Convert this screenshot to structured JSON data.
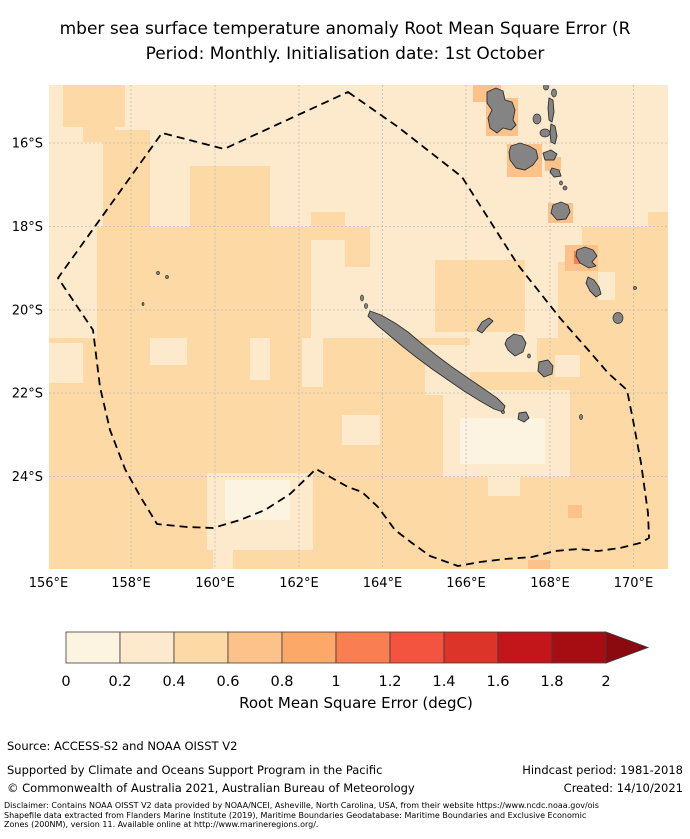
{
  "title": {
    "line1": "mber sea surface temperature anomaly Root Mean Square Error (R",
    "line2": "Period: Monthly. Initialisation date: 1st October"
  },
  "map": {
    "x_tick_labels": [
      "156°E",
      "158°E",
      "160°E",
      "162°E",
      "164°E",
      "166°E",
      "168°E",
      "170°E"
    ],
    "y_tick_labels": [
      "16°S",
      "18°S",
      "20°S",
      "22°S",
      "24°S"
    ],
    "land_color": "#848484",
    "land_edge_color": "#2f2f2f",
    "grid_color": "#bdbdbd",
    "eez_color": "#000000",
    "ocean_base_bin": 1
  },
  "colorbar": {
    "label": "Root Mean Square Error (degC)",
    "tick_labels": [
      "0",
      "0.2",
      "0.4",
      "0.6",
      "0.8",
      "1",
      "1.2",
      "1.4",
      "1.6",
      "1.8",
      "2"
    ],
    "colors": [
      "#fdf3e1",
      "#fdeacc",
      "#fcd9a5",
      "#fcc289",
      "#fba869",
      "#f97e52",
      "#f25440",
      "#dc3428",
      "#c3161b",
      "#a60d12"
    ],
    "arrow_color": "#8a0a10",
    "border_color": "#3c3c3c"
  },
  "footer": {
    "source": "Source: ACCESS-S2 and NOAA OISST V2",
    "supported": "Supported by Climate and Oceans Support Program in the Pacific",
    "hindcast": "Hindcast period: 1981-2018",
    "copyright": "© Commonwealth of Australia 2021, Australian Bureau of Meteorology",
    "created": "Created: 14/10/2021",
    "disclaimer_lines": [
      "Disclaimer: Contains NOAA OISST V2 data provided by NOAA/NCEI, Asheville, North Carolina, USA, from their website https://www.ncdc.noaa.gov/ois",
      "Shapefile data extracted from Flanders Marine Institute (2019), Maritime Boundaries Geodatabase: Maritime Boundaries and Exclusive Economic",
      "Zones (200NM), version 11. Available online at http://www.marineregions.org/."
    ]
  },
  "chart_data": {
    "type": "heatmap",
    "title": "mber sea surface temperature anomaly Root Mean Square Error (R",
    "subtitle": "Period: Monthly. Initialisation date: 1st October",
    "xlabel": "",
    "ylabel": "",
    "x_axis_ticks": [
      "156°E",
      "158°E",
      "160°E",
      "162°E",
      "164°E",
      "166°E",
      "168°E",
      "170°E"
    ],
    "y_axis_ticks": [
      "16°S",
      "18°S",
      "20°S",
      "22°S",
      "24°S"
    ],
    "lon_range_deg_east": [
      155.9,
      170.7
    ],
    "lat_range_deg_south": [
      14.6,
      26.2
    ],
    "colorbar": {
      "label": "Root Mean Square Error (degC)",
      "ticks": [
        0,
        0.2,
        0.4,
        0.6,
        0.8,
        1,
        1.2,
        1.4,
        1.6,
        1.8,
        2
      ],
      "extend": "max",
      "bin_colors": [
        "#fdf3e1",
        "#fdeacc",
        "#fcd9a5",
        "#fcc289",
        "#fba869",
        "#f97e52",
        "#f25440",
        "#dc3428",
        "#c3161b",
        "#a60d12"
      ]
    },
    "field_summary": {
      "north_of_20S": "mostly 0.2-0.4 degC",
      "south_of_20S": "mostly 0.4-0.6 degC with 0.2-0.4 and 0-0.2 patches southeast of New Caledonia and near 161E 24.5S",
      "near_vanuatu_islands": "0.6-0.8 degC cells, one 1.0-1.2 degC cell west of Erromango",
      "overlays": [
        "dashed EEZ boundary polygon",
        "New Caledonia",
        "Loyalty Islands",
        "Vanuatu island chain",
        "Chesterfield reef dots"
      ]
    },
    "geometry": {
      "map_rect": {
        "x": 49,
        "y": 85,
        "w": 619,
        "h": 484
      },
      "x_tick_px": [
        48.5,
        131,
        215,
        299,
        382.5,
        466,
        550,
        633.5
      ],
      "y_tick_px": [
        143,
        226.5,
        310,
        393,
        476.5
      ],
      "x_label_baseline": 587,
      "y_label_right": 43,
      "patches": [
        [
          63,
          85,
          62,
          42,
          2
        ],
        [
          83,
          120,
          32,
          22,
          2
        ],
        [
          103,
          130,
          47,
          100,
          2
        ],
        [
          190,
          166,
          80,
          61,
          2
        ],
        [
          97,
          227,
          214,
          118,
          2
        ],
        [
          311,
          212,
          34,
          28,
          2
        ],
        [
          648,
          212,
          20,
          26,
          2
        ],
        [
          582,
          227,
          86,
          40,
          2
        ],
        [
          558,
          262,
          110,
          83,
          2
        ],
        [
          435,
          260,
          90,
          72,
          2
        ],
        [
          345,
          227,
          25,
          40,
          2
        ],
        [
          49,
          338,
          619,
          231,
          2
        ],
        [
          150,
          338,
          37,
          27,
          1
        ],
        [
          250,
          338,
          20,
          42,
          1
        ],
        [
          302,
          338,
          21,
          49,
          1
        ],
        [
          49,
          343,
          34,
          40,
          1
        ],
        [
          342,
          415,
          38,
          30,
          1
        ],
        [
          470,
          332,
          67,
          40,
          1
        ],
        [
          425,
          345,
          45,
          50,
          1
        ],
        [
          555,
          355,
          25,
          22,
          1
        ],
        [
          443,
          390,
          127,
          87,
          1
        ],
        [
          207,
          473,
          106,
          77,
          1
        ],
        [
          213,
          550,
          20,
          19,
          1
        ],
        [
          598,
          272,
          17,
          28,
          1
        ],
        [
          488,
          467,
          32,
          29,
          1
        ],
        [
          460,
          418,
          85,
          46,
          0
        ],
        [
          225,
          480,
          65,
          40,
          0
        ],
        [
          473,
          85,
          28,
          17,
          3
        ],
        [
          486,
          98,
          32,
          38,
          3
        ],
        [
          507,
          144,
          35,
          33,
          3
        ],
        [
          545,
          157,
          16,
          14,
          3
        ],
        [
          548,
          203,
          25,
          20,
          3
        ],
        [
          565,
          245,
          33,
          26,
          3
        ],
        [
          568,
          505,
          14,
          13,
          3
        ],
        [
          528,
          560,
          22,
          9,
          3
        ],
        [
          574,
          251,
          16,
          13,
          5
        ]
      ],
      "eez_path": "M348,92 L398,127 L462,177 L518,265 L560,318 L590,352 L608,373 L627,390 L633,420 L641,463 L648,513 L649,538 L640,543 L620,548 L598,551 L578,549 L555,551 L532,557 L505,559 L480,562 L458,566 L430,556 L412,543 L395,530 L378,507 L362,492 L348,487 L316,469 L290,494 L265,510 L240,520 L213,528 L187,527 L157,524 L140,496 L125,469 L110,430 L100,387 L93,330 L58,278 L162,133 L224,149 Z",
      "islands": [
        {
          "t": "p",
          "pts": "487,92 496,88 503,91 505,100 512,102 515,110 513,120 516,125 511,130 503,128 497,133 490,128 488,118 492,110 487,103"
        },
        {
          "t": "e",
          "cx": 546,
          "cy": 87,
          "rx": 2.5,
          "ry": 3
        },
        {
          "t": "e",
          "cx": 554,
          "cy": 93,
          "rx": 2.5,
          "ry": 4
        },
        {
          "t": "e",
          "cx": 537,
          "cy": 119,
          "rx": 4,
          "ry": 5
        },
        {
          "t": "e",
          "cx": 545,
          "cy": 133,
          "rx": 5,
          "ry": 4
        },
        {
          "t": "p",
          "pts": "549,98 553,100 554,112 552,122 549,120 548,108"
        },
        {
          "t": "p",
          "pts": "551,124 555,126 557,136 555,144 551,142 550,133"
        },
        {
          "t": "p",
          "pts": "511,146 520,143 529,146 536,150 538,158 533,165 525,170 516,168 510,160 509,152"
        },
        {
          "t": "p",
          "pts": "543,153 551,150 557,154 554,160 545,160"
        },
        {
          "t": "p",
          "pts": "552,168 559,170 561,176 554,177 550,172"
        },
        {
          "t": "e",
          "cx": 561,
          "cy": 183,
          "rx": 1.5,
          "ry": 2
        },
        {
          "t": "e",
          "cx": 565,
          "cy": 188,
          "rx": 2,
          "ry": 2
        },
        {
          "t": "p",
          "pts": "553,205 561,202 568,205 570,212 566,219 557,220 551,213"
        },
        {
          "t": "p",
          "pts": "577,250 585,247 593,250 597,256 592,262 596,266 589,268 580,263 576,256"
        },
        {
          "t": "p",
          "pts": "588,277 594,280 599,287 601,294 596,297 590,291 586,283"
        },
        {
          "t": "e",
          "cx": 618,
          "cy": 318,
          "rx": 5,
          "ry": 5.5
        },
        {
          "t": "e",
          "cx": 635,
          "cy": 288,
          "rx": 1.5,
          "ry": 1.5
        },
        {
          "t": "p",
          "pts": "370,311 381,315 395,323 408,332 421,343 436,355 452,367 468,378 484,389 497,398 505,406 503,412 494,409 480,401 464,391 448,380 432,369 416,357 402,346 389,335 377,325 368,316"
        },
        {
          "t": "e",
          "cx": 362,
          "cy": 298,
          "rx": 1.5,
          "ry": 3
        },
        {
          "t": "e",
          "cx": 366,
          "cy": 306,
          "rx": 1.5,
          "ry": 2.5
        },
        {
          "t": "e",
          "cx": 503,
          "cy": 412,
          "rx": 1.5,
          "ry": 1.5
        },
        {
          "t": "p",
          "pts": "519,413 526,412 529,418 524,422 518,419"
        },
        {
          "t": "p",
          "pts": "477,330 482,322 489,318 493,321 487,327 482,333"
        },
        {
          "t": "p",
          "pts": "507,339 514,334 522,336 526,343 523,352 515,356 508,350 505,344"
        },
        {
          "t": "e",
          "cx": 529,
          "cy": 356,
          "rx": 1.5,
          "ry": 2
        },
        {
          "t": "p",
          "pts": "539,362 548,360 553,366 552,374 544,377 538,371"
        },
        {
          "t": "e",
          "cx": 581,
          "cy": 417,
          "rx": 1.5,
          "ry": 2.5
        },
        {
          "t": "e",
          "cx": 158,
          "cy": 273,
          "rx": 1.5,
          "ry": 1.5
        },
        {
          "t": "e",
          "cx": 167,
          "cy": 277,
          "rx": 1.5,
          "ry": 1.5
        },
        {
          "t": "e",
          "cx": 143,
          "cy": 304,
          "rx": 1,
          "ry": 1.5
        }
      ],
      "colorbar": {
        "x": 66,
        "y": 632,
        "seg_w": 54,
        "h": 31,
        "arrow_tip_x": 648,
        "tick_baseline": 686,
        "label_cx": 356,
        "label_baseline": 708
      }
    }
  }
}
